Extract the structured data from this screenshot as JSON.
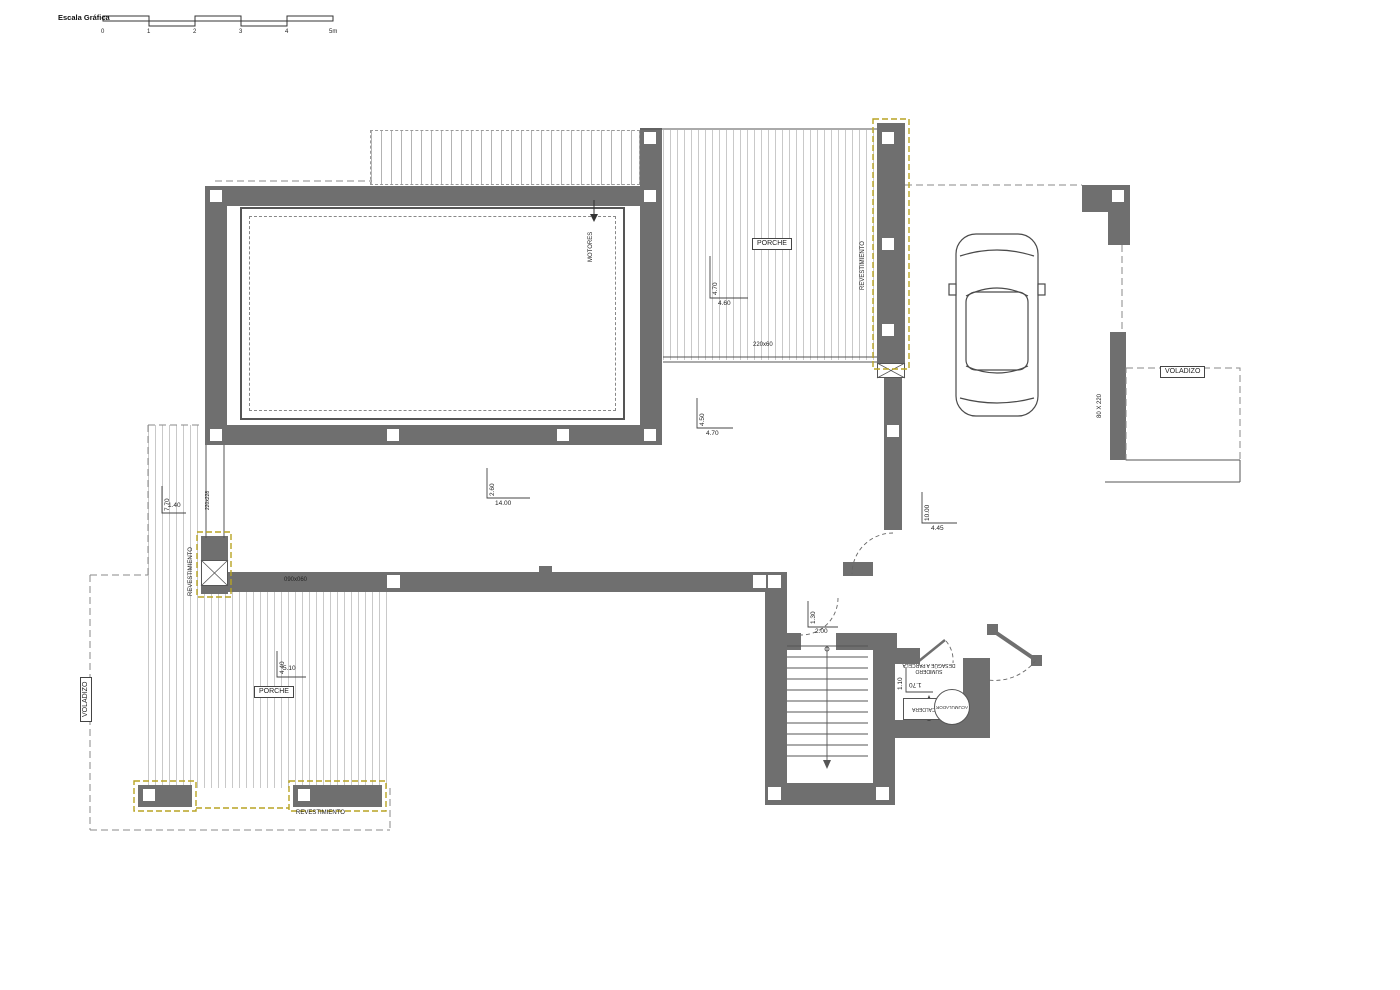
{
  "scale_bar": {
    "title": "Escala Gráfica",
    "ticks": [
      "0",
      "1",
      "2",
      "3",
      "4",
      "5m"
    ]
  },
  "labels": {
    "porche_top": "PORCHE",
    "porche_left": "PORCHE",
    "voladizo_right": "VOLADIZO",
    "voladizo_left": "VOLADIZO",
    "revestimiento_top": "REVESTIMIENTO",
    "revestimiento_left": "REVESTIMIENTO",
    "revestimiento_bottom": "REVESTIMIENTO",
    "motores": "MOTORES",
    "caldera": "CALDERA",
    "acumulador": "ACUMULADOR",
    "sumidero_line1": "SUMIDERO",
    "sumidero_line2": "DESAGÜE A PARCELA",
    "window_top": "220x60",
    "window_left": "220x228",
    "window_bottom": "090x060",
    "door_right": "80 X 220"
  },
  "dims": {
    "porche_top_v": "4.70",
    "porche_top_h": "4.60",
    "salon_v": "4.50",
    "salon_h": "4.70",
    "main_v": "2.60",
    "main_h": "14.00",
    "hall_v": "10.00",
    "hall_h": "4.45",
    "entry_v": "1.30",
    "entry_h": "2.00",
    "porchL_top_v": "7.70",
    "porchL_top_h": "1.40",
    "porchL_v": "4.40",
    "porchL_h": "5.10",
    "utility_v": "1.10",
    "utility_h": "1.70"
  },
  "colors": {
    "wall": "#6f6f6f",
    "highlight": "#b8a423",
    "stripe": "#c9c9c9",
    "line": "#555555",
    "dash": "#8a8a8a"
  }
}
